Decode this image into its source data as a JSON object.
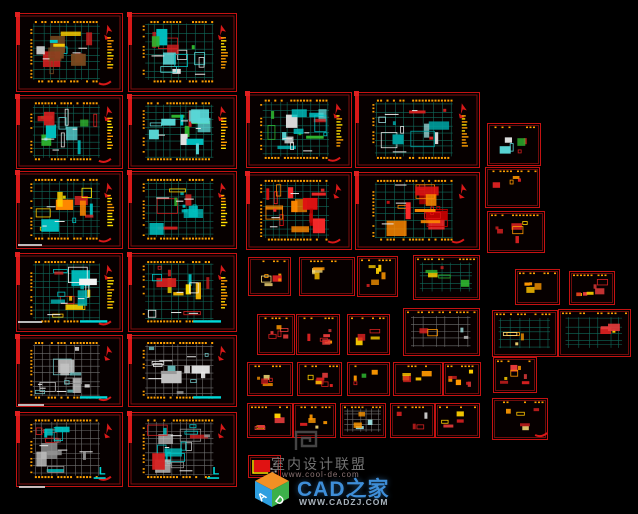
{
  "canvas": {
    "width": 638,
    "height": 514,
    "background": "#000000"
  },
  "colors": {
    "frame_border": "#c41212",
    "frame_inner": "#7e0e0e",
    "red": "#d81818",
    "red_fill": "#e01212",
    "dim": "#ffa000",
    "grid": "#11695a",
    "grid_gray": "#6f6f6f",
    "legend_yellow": "#ffe000",
    "cyan": "#00d8d8",
    "white_wall": "#e8e8e8"
  },
  "palettes": {
    "mixed": [
      "#00c8c8",
      "#2fb52f",
      "#ffd000",
      "#d42020",
      "#d8d8d8",
      "#7a4a20"
    ],
    "cyanmix": [
      "#00c0c0",
      "#59d7d7",
      "#d42020",
      "#e0e0e0",
      "#2fb52f"
    ],
    "cyanwhite": [
      "#9adada",
      "#e6e6e6",
      "#00a0a0",
      "#d42020"
    ],
    "yellowred": [
      "#ffd000",
      "#ffea00",
      "#d42020",
      "#ff8800",
      "#00c0c0"
    ],
    "greenmix": [
      "#2fb52f",
      "#00c0c0",
      "#ffd000",
      "#d42020"
    ],
    "yellow": [
      "#ffe000",
      "#ffc000",
      "#d42020",
      "#f5f5f5",
      "#00c0c0"
    ],
    "gray": [
      "#c4c4c4",
      "#8f8f8f",
      "#67b7b7",
      "#e8e8e8"
    ],
    "grayred": [
      "#c0c0c0",
      "#d42020",
      "#929292",
      "#00c0c0"
    ],
    "red": [
      "#e01212",
      "#c40000",
      "#ff2a2a",
      "#ff8800"
    ],
    "orange": [
      "#ff9800",
      "#ffc400",
      "#d42020",
      "#ffe27a"
    ],
    "gold": [
      "#ffd000",
      "#ff9800",
      "#d42020"
    ],
    "redorange": [
      "#d42020",
      "#ff9800",
      "#e43b3b",
      "#ffd000"
    ],
    "greenred": [
      "#2fb52f",
      "#d42020",
      "#ff9800"
    ],
    "graygrid": [
      "#c0c0c0",
      "#d42020",
      "#9adada",
      "#ff9800"
    ]
  },
  "frames": [
    {
      "x": 16,
      "y": 13,
      "w": 105,
      "h": 77,
      "palette": "mixed",
      "seed": 1,
      "arrow": 1,
      "side": 1
    },
    {
      "x": 128,
      "y": 13,
      "w": 107,
      "h": 77,
      "palette": "cyanmix",
      "seed": 2,
      "arrow": 1,
      "side": 1
    },
    {
      "x": 16,
      "y": 95,
      "w": 105,
      "h": 72,
      "palette": "cyanmix",
      "seed": 3,
      "arrow": 1,
      "side": 1
    },
    {
      "x": 128,
      "y": 95,
      "w": 107,
      "h": 72,
      "palette": "cyanmix",
      "seed": 4,
      "arrow": 1,
      "side": 1
    },
    {
      "x": 16,
      "y": 171,
      "w": 105,
      "h": 76,
      "palette": "yellowred",
      "seed": 5,
      "arrow": 1,
      "side": 1
    },
    {
      "x": 128,
      "y": 171,
      "w": 107,
      "h": 76,
      "palette": "greenmix",
      "seed": 6,
      "arrow": 1,
      "side": 1
    },
    {
      "x": 16,
      "y": 253,
      "w": 105,
      "h": 77,
      "palette": "yellow",
      "seed": 7,
      "arrow": 1,
      "side": 1,
      "cyanbar": 1
    },
    {
      "x": 128,
      "y": 253,
      "w": 107,
      "h": 77,
      "palette": "yellow",
      "seed": 8,
      "arrow": 1,
      "side": 1,
      "cyanbar": 1
    },
    {
      "x": 16,
      "y": 335,
      "w": 105,
      "h": 70,
      "palette": "gray",
      "seed": 9,
      "arrow": 1,
      "cyanbar": 1
    },
    {
      "x": 128,
      "y": 335,
      "w": 107,
      "h": 70,
      "palette": "gray",
      "seed": 10,
      "arrow": 1,
      "cyanbar": 1
    },
    {
      "x": 16,
      "y": 412,
      "w": 105,
      "h": 73,
      "palette": "grayred",
      "seed": 11,
      "arrow": 1,
      "cyanL": 1
    },
    {
      "x": 128,
      "y": 412,
      "w": 107,
      "h": 73,
      "palette": "grayred",
      "seed": 12,
      "arrow": 1,
      "cyanL": 1
    },
    {
      "x": 246,
      "y": 92,
      "w": 104,
      "h": 74,
      "palette": "cyanmix",
      "seed": 13,
      "arrow": 1,
      "side": 1
    },
    {
      "x": 355,
      "y": 92,
      "w": 123,
      "h": 74,
      "palette": "cyanwhite",
      "seed": 14,
      "arrow": 1,
      "side": 1
    },
    {
      "x": 246,
      "y": 172,
      "w": 104,
      "h": 76,
      "palette": "red",
      "seed": 15,
      "arrow": 1,
      "swoosh": 1
    },
    {
      "x": 355,
      "y": 172,
      "w": 123,
      "h": 76,
      "palette": "red",
      "seed": 16,
      "arrow": 1,
      "swoosh": 1
    },
    {
      "x": 248,
      "y": 257,
      "w": 41,
      "h": 37,
      "palette": "orange",
      "seed": 17,
      "small": 1
    },
    {
      "x": 299,
      "y": 257,
      "w": 54,
      "h": 37,
      "palette": "orange",
      "seed": 18,
      "small": 1
    },
    {
      "x": 357,
      "y": 256,
      "w": 39,
      "h": 39,
      "palette": "gold",
      "seed": 19,
      "small": 1
    },
    {
      "x": 413,
      "y": 255,
      "w": 65,
      "h": 43,
      "palette": "greenmix",
      "seed": 20,
      "small": 1
    },
    {
      "x": 257,
      "y": 314,
      "w": 36,
      "h": 39,
      "palette": "redorange",
      "seed": 21,
      "small": 1
    },
    {
      "x": 296,
      "y": 314,
      "w": 42,
      "h": 39,
      "palette": "redorange",
      "seed": 22,
      "small": 1
    },
    {
      "x": 347,
      "y": 314,
      "w": 41,
      "h": 39,
      "palette": "gold",
      "seed": 23,
      "small": 1
    },
    {
      "x": 403,
      "y": 308,
      "w": 75,
      "h": 46,
      "palette": "graygrid",
      "seed": 24,
      "small": 1
    },
    {
      "x": 247,
      "y": 362,
      "w": 44,
      "h": 32,
      "palette": "orange",
      "seed": 25,
      "small": 1
    },
    {
      "x": 297,
      "y": 362,
      "w": 43,
      "h": 32,
      "palette": "redorange",
      "seed": 26,
      "small": 1
    },
    {
      "x": 347,
      "y": 362,
      "w": 41,
      "h": 32,
      "palette": "greenred",
      "seed": 27,
      "small": 1
    },
    {
      "x": 393,
      "y": 362,
      "w": 48,
      "h": 32,
      "palette": "orange",
      "seed": 28,
      "small": 1
    },
    {
      "x": 443,
      "y": 362,
      "w": 36,
      "h": 32,
      "palette": "redorange",
      "seed": 29,
      "small": 1
    },
    {
      "x": 247,
      "y": 403,
      "w": 44,
      "h": 33,
      "palette": "redorange",
      "seed": 30,
      "small": 1
    },
    {
      "x": 293,
      "y": 403,
      "w": 41,
      "h": 33,
      "palette": "orange",
      "seed": 31,
      "small": 1
    },
    {
      "x": 340,
      "y": 403,
      "w": 44,
      "h": 33,
      "palette": "graygrid",
      "seed": 32,
      "small": 1
    },
    {
      "x": 390,
      "y": 403,
      "w": 43,
      "h": 33,
      "palette": "cyanmix",
      "seed": 33,
      "small": 1
    },
    {
      "x": 435,
      "y": 403,
      "w": 43,
      "h": 33,
      "palette": "redorange",
      "seed": 34,
      "small": 1
    },
    {
      "x": 248,
      "y": 455,
      "w": 31,
      "h": 21,
      "palette": "gold",
      "seed": 35,
      "small": 1,
      "kind": "legend"
    },
    {
      "x": 487,
      "y": 123,
      "w": 52,
      "h": 41,
      "palette": "cyanmix",
      "seed": 36,
      "small": 1
    },
    {
      "x": 485,
      "y": 167,
      "w": 53,
      "h": 39,
      "palette": "greenred",
      "seed": 37,
      "small": 1
    },
    {
      "x": 487,
      "y": 211,
      "w": 56,
      "h": 40,
      "palette": "redorange",
      "seed": 38,
      "small": 1
    },
    {
      "x": 515,
      "y": 269,
      "w": 43,
      "h": 34,
      "palette": "orange",
      "seed": 39,
      "small": 1
    },
    {
      "x": 569,
      "y": 271,
      "w": 44,
      "h": 32,
      "palette": "redorange",
      "seed": 40,
      "small": 1
    },
    {
      "x": 492,
      "y": 310,
      "w": 64,
      "h": 45,
      "palette": "orange",
      "seed": 41,
      "small": 1
    },
    {
      "x": 558,
      "y": 309,
      "w": 71,
      "h": 46,
      "palette": "redorange",
      "seed": 42,
      "small": 1
    },
    {
      "x": 493,
      "y": 357,
      "w": 42,
      "h": 34,
      "palette": "redorange",
      "seed": 43,
      "small": 1
    },
    {
      "x": 492,
      "y": 398,
      "w": 54,
      "h": 40,
      "palette": "orange",
      "seed": 44,
      "small": 1,
      "swoosh": 1
    }
  ],
  "title_dashes": [
    {
      "x": 18,
      "y": 244,
      "w": 24
    },
    {
      "x": 18,
      "y": 321,
      "w": 24
    },
    {
      "x": 18,
      "y": 404,
      "w": 26
    },
    {
      "x": 19,
      "y": 486,
      "w": 26
    }
  ],
  "watermark_center": {
    "title": "室内设计联盟",
    "subtitle": "www.cool-de.com"
  },
  "brand": {
    "cube_letter_a": "A",
    "cube_letter_d": "D",
    "name": "CAD之家",
    "site": "WWW.CADZJ.COM",
    "name_color": "#3e8ed8",
    "cube_top": "#f29024",
    "cube_left": "#2e9fe0",
    "cube_right": "#3cb04a"
  }
}
